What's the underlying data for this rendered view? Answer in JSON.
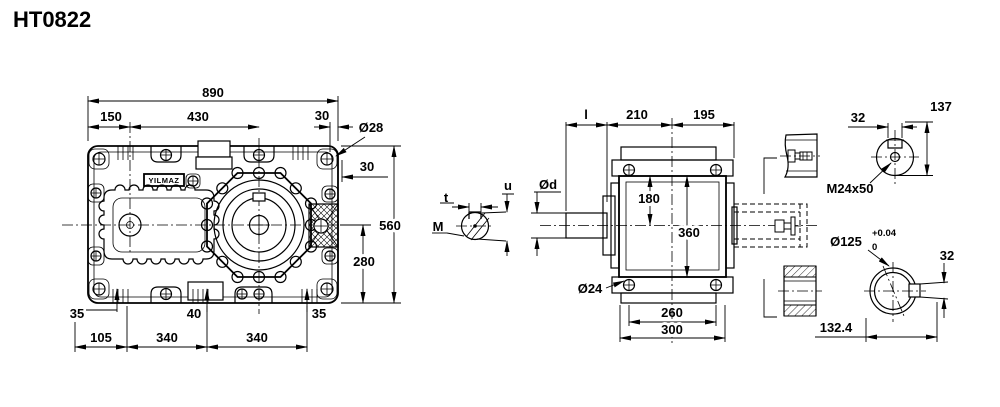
{
  "title": "HT0822",
  "brand": "YILMAZ",
  "accent_color": "#000000",
  "front": {
    "total_width": "890",
    "left_axis_offset": "150",
    "axis_distance": "430",
    "top_bolt_offset": "30",
    "bolt_hole_dia": "Ø28",
    "side_bolt_offset": "30",
    "total_height": "560",
    "axis_height": "280",
    "foot_rib_left": "35",
    "foot_rib_mid": "40",
    "foot_rib_right": "35",
    "foot_offset": "105",
    "foot_span_1": "340",
    "foot_span_2": "340"
  },
  "input_shaft": {
    "key_width": "t",
    "key_height": "u",
    "thread": "M",
    "dia": "Ød",
    "length": "l"
  },
  "side": {
    "front_depth": "210",
    "rear_depth": "195",
    "top_to_axis": "180",
    "housing_height": "360",
    "foot_hole_dia": "Ø24",
    "bolt_span": "260",
    "base_width": "300"
  },
  "output_end": {
    "key_width_top": "32",
    "shaft_height": "137",
    "center_thread": "M24x50",
    "bore_dia": "Ø125",
    "bore_tol_plus": "+0.04",
    "bore_tol_minus": "0",
    "key_width_side": "32",
    "end_offset": "132.4"
  }
}
